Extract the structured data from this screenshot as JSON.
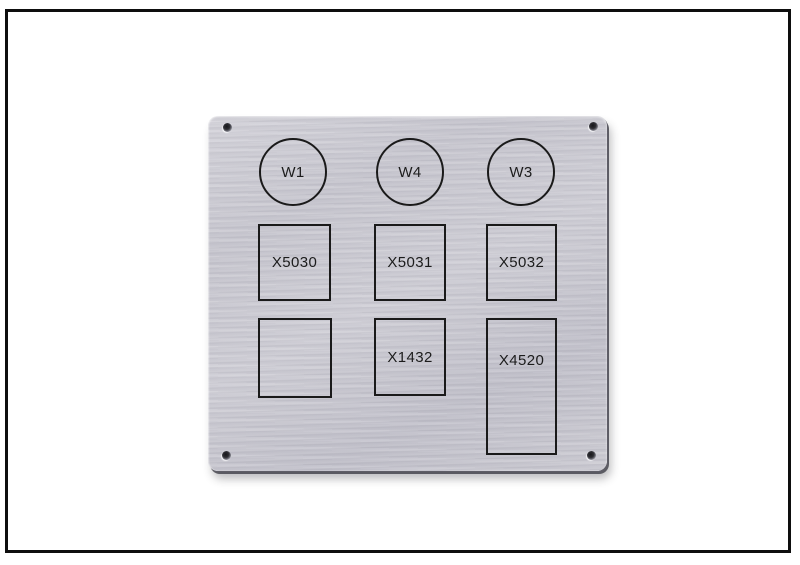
{
  "frame": {
    "border_color": "#0e0e0e",
    "background_color": "#ffffff"
  },
  "panel": {
    "base_color": "#c7c6cf",
    "outline_color": "#1a1a1a",
    "text_color": "#1c1c1c",
    "circles": [
      {
        "label": "W1"
      },
      {
        "label": "W4"
      },
      {
        "label": "W3"
      }
    ],
    "cutouts_row1": [
      {
        "label": "X5030"
      },
      {
        "label": "X5031"
      },
      {
        "label": "X5032"
      }
    ],
    "cutouts_row2": [
      {
        "label": ""
      },
      {
        "label": "X1432"
      },
      {
        "label": "X4520"
      }
    ]
  }
}
